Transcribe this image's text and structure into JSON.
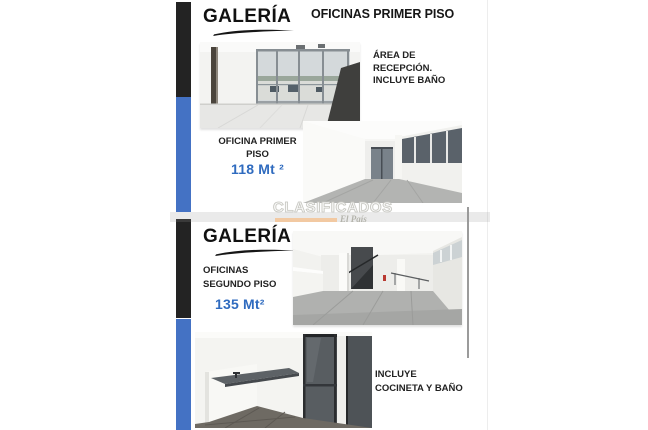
{
  "colors": {
    "accent_bar_blue": "#4472C4",
    "accent_bar_black": "#232323",
    "area_text_blue": "#2F6BBF",
    "watermark_underline_orange": "#F2C9A2"
  },
  "flyer": {
    "top": {
      "logo": "GALERÍA",
      "heading": "OFICINAS PRIMER PISO"
    },
    "reception_note": [
      "ÁREA DE",
      "RECEPCIÓN.",
      "INCLUYE BAÑO"
    ],
    "office1": {
      "label_line1": "OFICINA PRIMER",
      "label_line2": "PISO",
      "area": "118 Mt ²"
    },
    "watermark": {
      "title": "CLASIFICADOS",
      "brand": "El País"
    },
    "bottom": {
      "logo": "GALERÍA",
      "label_line1": "OFICINAS",
      "label_line2": "SEGUNDO PISO",
      "area": "135 Mt²",
      "note_line1": "INCLUYE",
      "note_line2": "COCINETA Y BAÑO"
    }
  }
}
